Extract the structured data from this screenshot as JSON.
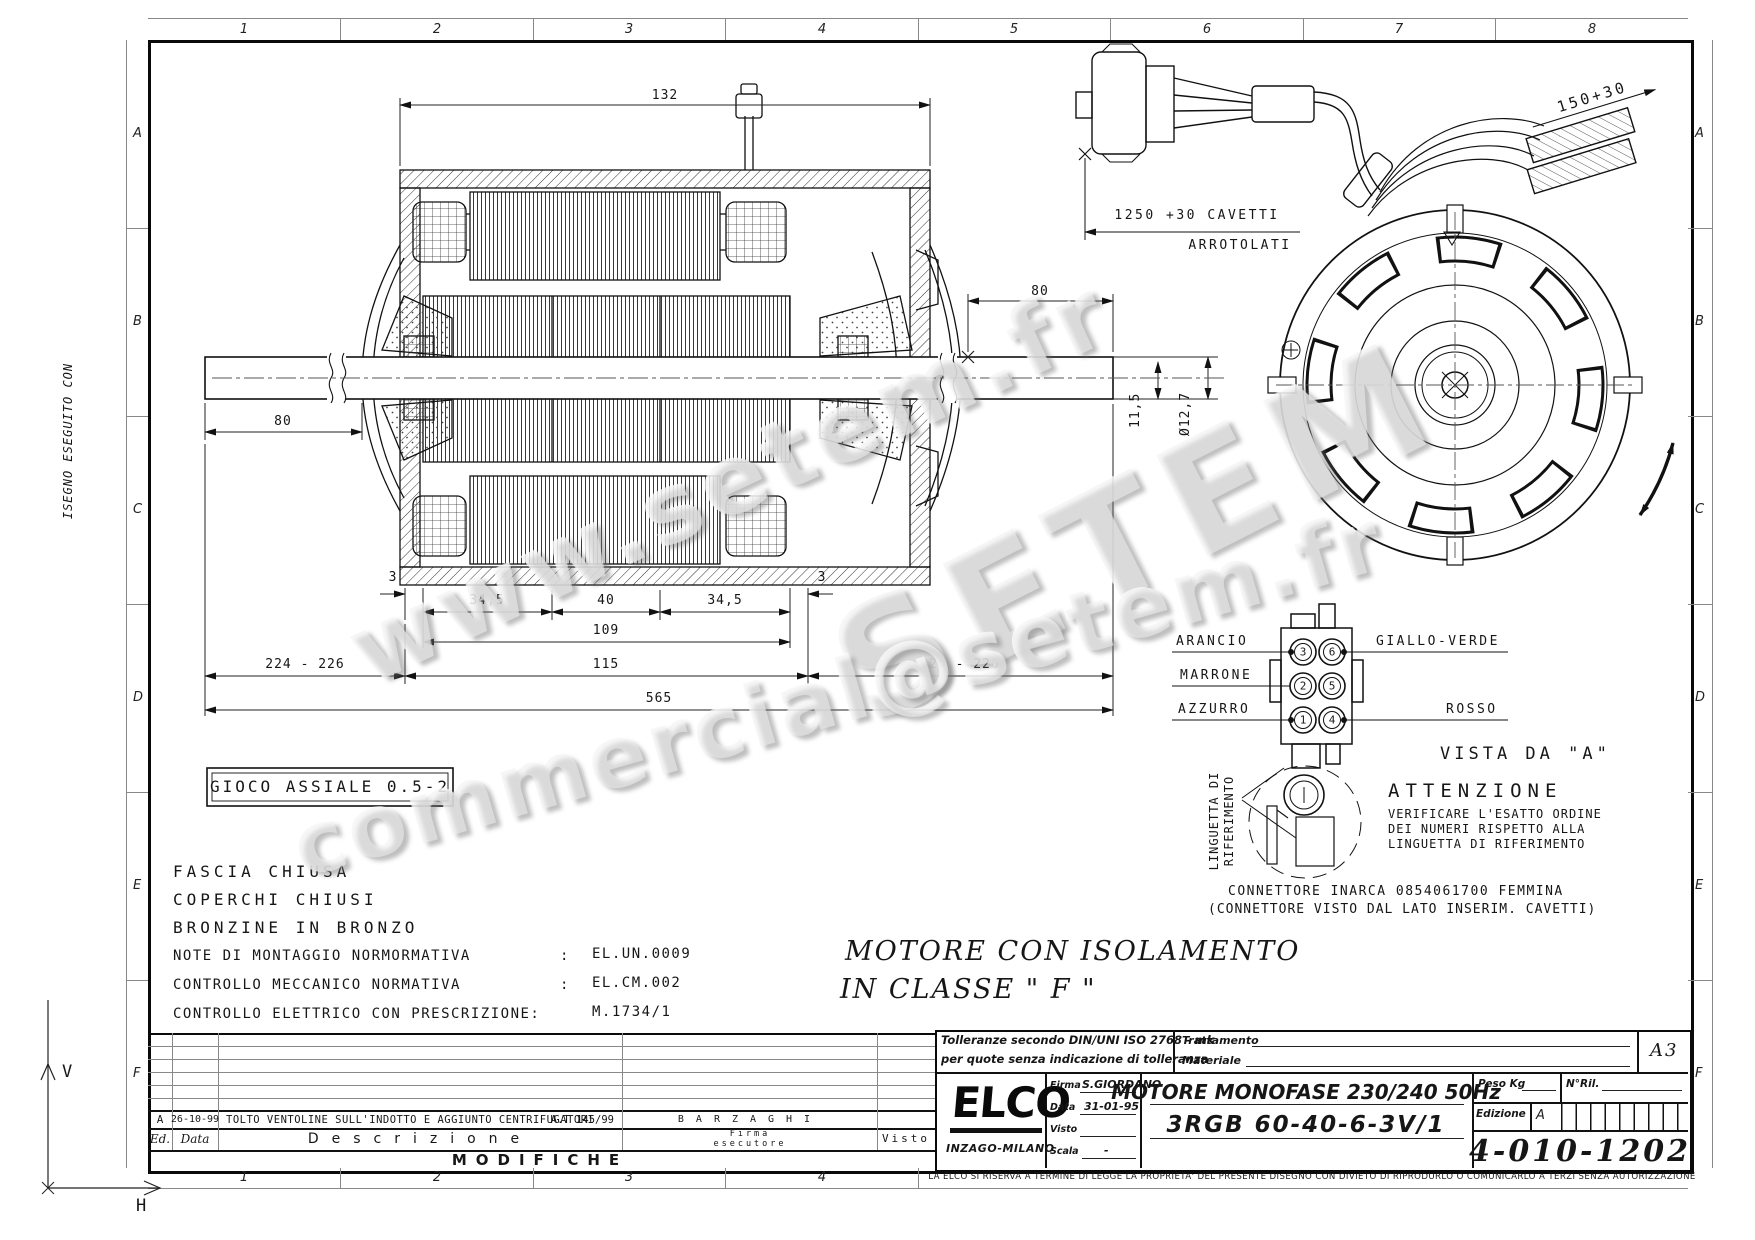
{
  "sheet": {
    "border_columns": [
      "1",
      "2",
      "3",
      "4",
      "5",
      "6",
      "7",
      "8"
    ],
    "bottom_columns": [
      "1",
      "2",
      "3",
      "4"
    ],
    "border_rows": [
      "A",
      "B",
      "C",
      "D",
      "E",
      "F"
    ],
    "side_note": "ISEGNO ESEGUITO CON",
    "datum_v": "V",
    "datum_h": "H"
  },
  "watermarks": {
    "w1": "www.setem.fr",
    "w2": "SETEM",
    "w3": "commercial@setem.fr"
  },
  "side_view": {
    "dims": {
      "top_length": "132",
      "shaft_right": "80",
      "shaft_left": "80",
      "wall_left": "3",
      "wall_right": "3",
      "pack_left": "34,5",
      "pack_center": "40",
      "pack_right": "34,5",
      "pack_total": "109",
      "stator_total": "115",
      "shaft_span": "224 - 226",
      "overall": "565",
      "shaft_flat": "11,5",
      "shaft_dia": "Ø12,7"
    },
    "gioco_box": "GIOCO ASSIALE   0.5-2"
  },
  "cable": {
    "dim_length": "1250 +30 CAVETTI",
    "dim_note": "ARROTOLATI",
    "lead_dim": "150+30"
  },
  "notes": {
    "line1": "FASCIA CHIUSA",
    "line2": "COPERCHI CHIUSI",
    "line3": "BRONZINE IN BRONZO",
    "row1_label": "NOTE DI MONTAGGIO NORMORMATIVA",
    "row1_sep": ":",
    "row1_value": "EL.UN.0009",
    "row2_label": "CONTROLLO MECCANICO NORMATIVA",
    "row2_sep": ":",
    "row2_value": "EL.CM.002",
    "row3_label": "CONTROLLO ELETTRICO CON PRESCRIZIONE:",
    "row3_value": "M.1734/1",
    "iso_line1": "MOTORE CON ISOLAMENTO",
    "iso_line2": "IN CLASSE   \" F \""
  },
  "connector": {
    "wire_left": [
      "ARANCIO",
      "MARRONE",
      "AZZURRO"
    ],
    "wire_right": [
      "GIALLO-VERDE",
      "ROSSO"
    ],
    "pins": [
      [
        "3",
        "6"
      ],
      [
        "2",
        "5"
      ],
      [
        "1",
        "4"
      ]
    ],
    "vista": "VISTA DA \"A\"",
    "linguetta_line1": "LINGUETTA DI",
    "linguetta_line2": "RIFERIMENTO",
    "attenzione_title": "ATTENZIONE",
    "attenzione_l1": "VERIFICARE L'ESATTO ORDINE",
    "attenzione_l2": "DEI NUMERI RISPETTO ALLA",
    "attenzione_l3": "LINGUETTA DI RIFERIMENTO",
    "note_l1": "CONNETTORE INARCA 0854061700 FEMMINA",
    "note_l2": "(CONNETTORE VISTO DAL LATO INSERIM. CAVETTI)"
  },
  "title_block": {
    "tol_l1": "Tolleranze secondo DIN/UNI ISO 2768 - mk",
    "tol_l2": "per quote senza indicazione di tolleranza",
    "trattamento": "Trattamento",
    "materiale": "Materiale",
    "format": "A3",
    "company": "ELCO",
    "city": "INZAGO-MILANO",
    "firma_label": "Firma",
    "firma_value": "S.GIORDANO",
    "data_label": "Data",
    "data_value": "31-01-95",
    "visto_label": "Visto",
    "scala_label": "Scala",
    "scala_value": "-",
    "title_line1": "MOTORE MONOFASE 230/240 50Hz",
    "title_line2": "3RGB 60-40-6-3V/1",
    "peso_label": "Peso Kg",
    "nril_label": "N°Ril.",
    "edizione_label": "Edizione",
    "edizione_value": "A",
    "drawing_number": "4-010-1202",
    "disclaimer": "LA ELCO SI RISERVA A TERMINE DI LEGGE LA PROPRIETA' DEL PRESENTE DISEGNO CON DIVIETO DI RIPRODURLO O COMUNICARLO A TERZI SENZA AUTORIZZAZIONE"
  },
  "modifications": {
    "banner": "MODIFICHE",
    "headers": {
      "ed": "Ed.",
      "data": "Data",
      "desc": "Descrizione",
      "firma1": "Firma",
      "firma2": "esecutore",
      "visto": "Visto"
    },
    "row": {
      "ed": "A",
      "data": "26-10-99",
      "desc": "TOLTO VENTOLINE SULL'INDOTTO E AGGIUNTO CENTRIFUGATORI",
      "ref": "A.T 145/99",
      "firma": "BARZAGHI"
    }
  }
}
